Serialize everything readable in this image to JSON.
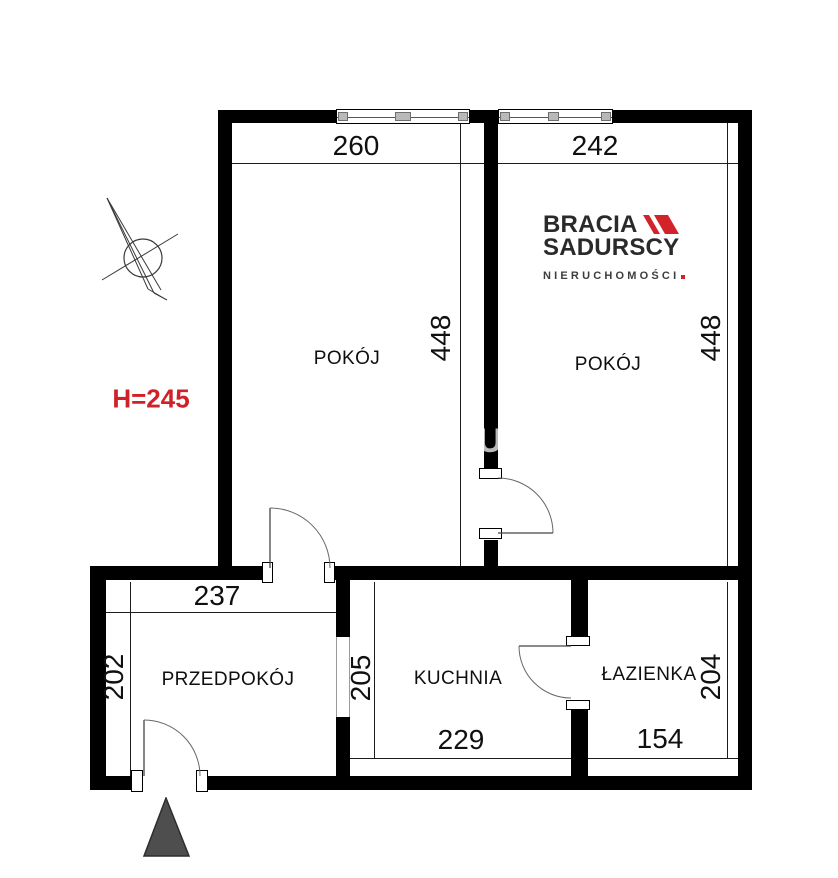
{
  "colors": {
    "wall": "#000000",
    "accent_red": "#cf2127",
    "logo_red": "#d2232a",
    "logo_text": "#2a2a2a",
    "entrance_triangle": "#4e4e4e",
    "watermark_gray": "#b9b9b9"
  },
  "plan": {
    "rooms": {
      "room_left": {
        "label": "POKÓJ",
        "width": "260",
        "depth": "448"
      },
      "room_right": {
        "label": "POKÓJ",
        "width": "242",
        "depth": "448"
      },
      "hallway": {
        "label": "PRZEDPOKÓJ",
        "width": "237",
        "depth": "202"
      },
      "kitchen": {
        "label": "KUCHNIA",
        "width": "229",
        "depth": "205"
      },
      "bathroom": {
        "label": "ŁAZIENKA",
        "width": "154",
        "depth": "204"
      }
    },
    "ceiling_height_note": "H=245",
    "watermark_fragment": "U"
  },
  "logo": {
    "line1": "BRACIA",
    "line2": "SADURSCY",
    "line3": "NIERUCHOMOŚCI"
  }
}
